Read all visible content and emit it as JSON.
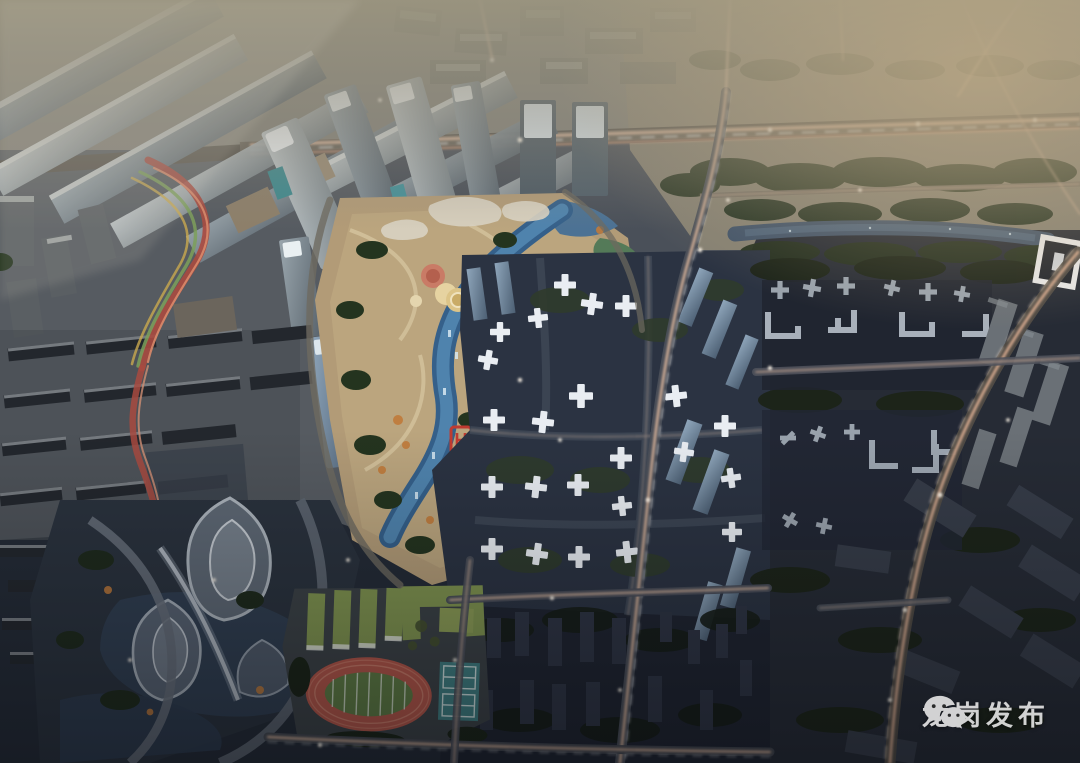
{
  "watermark": {
    "text": "龙岗发布",
    "icon": "wechat-icon",
    "color": "#e2e2e2"
  },
  "palette": {
    "haze_top": "#928c7e",
    "warm_glow": "#b3a385",
    "dusk_base": "#4a5059",
    "plaza_tan": "#b29b77",
    "plaza_path": "#d3c29c",
    "canal_blue": "#4f83ad",
    "canal_deep": "#35608a",
    "tree_green": "#24341f",
    "autumn_orange": "#c07a3a",
    "light_trail": "#f2c7ab",
    "night_block": "#2b3342",
    "right_block": "#262b35",
    "roof_glyph": "#9aa3ad",
    "tower_glass": "#aeb8bc",
    "tower_white_cap": "#eef2f4",
    "cross_tower": "#e9edf2",
    "track_red": "#b05548",
    "field_green": "#5d7a43",
    "court_teal": "#3f7d80",
    "school_roof": "#7f934f",
    "ribbon_red": "#a84a40",
    "helipad_red": "#c03b30"
  }
}
